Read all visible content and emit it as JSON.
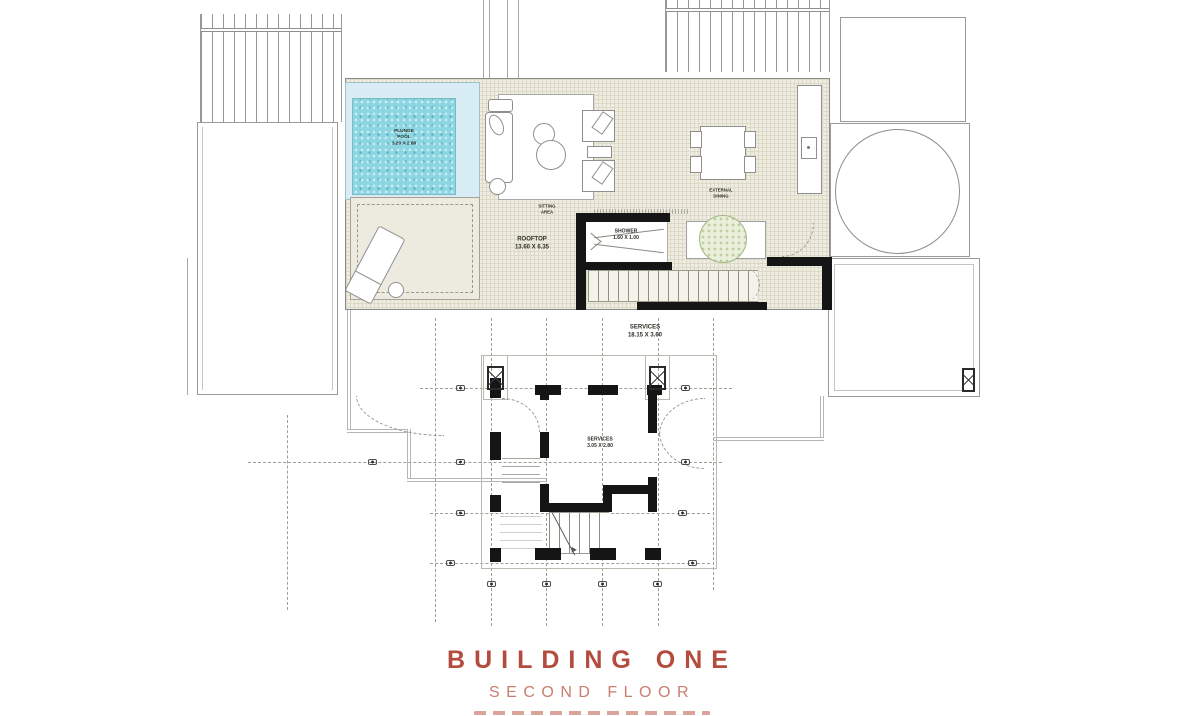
{
  "plan": {
    "pool_label": "PLUNGE\nPOOL\n3.20 X 2.80",
    "sitting_label": "SITTING\nAREA",
    "rooftop_label": "ROOFTOP\n13.60 X 6.35",
    "shower_label": "SHOWER\n1.60 X 1.00",
    "dining_label": "EXTERNAL\nDINING",
    "services_strip_label": "SERVICES\n18.15 X 3.60",
    "services_room_label": "SERVICES\n3.05 X 2.80"
  },
  "title": {
    "building": "BUILDING ONE",
    "floor": "SECOND FLOOR"
  },
  "colors": {
    "title_primary": "#b34b3e",
    "title_secondary": "#c97e6f",
    "pool_water": "#8cd6e2",
    "pool_deck": "#d7ecf4",
    "deck_tile": "#efede1",
    "wall": "#151515",
    "tree": "#a3b585"
  }
}
